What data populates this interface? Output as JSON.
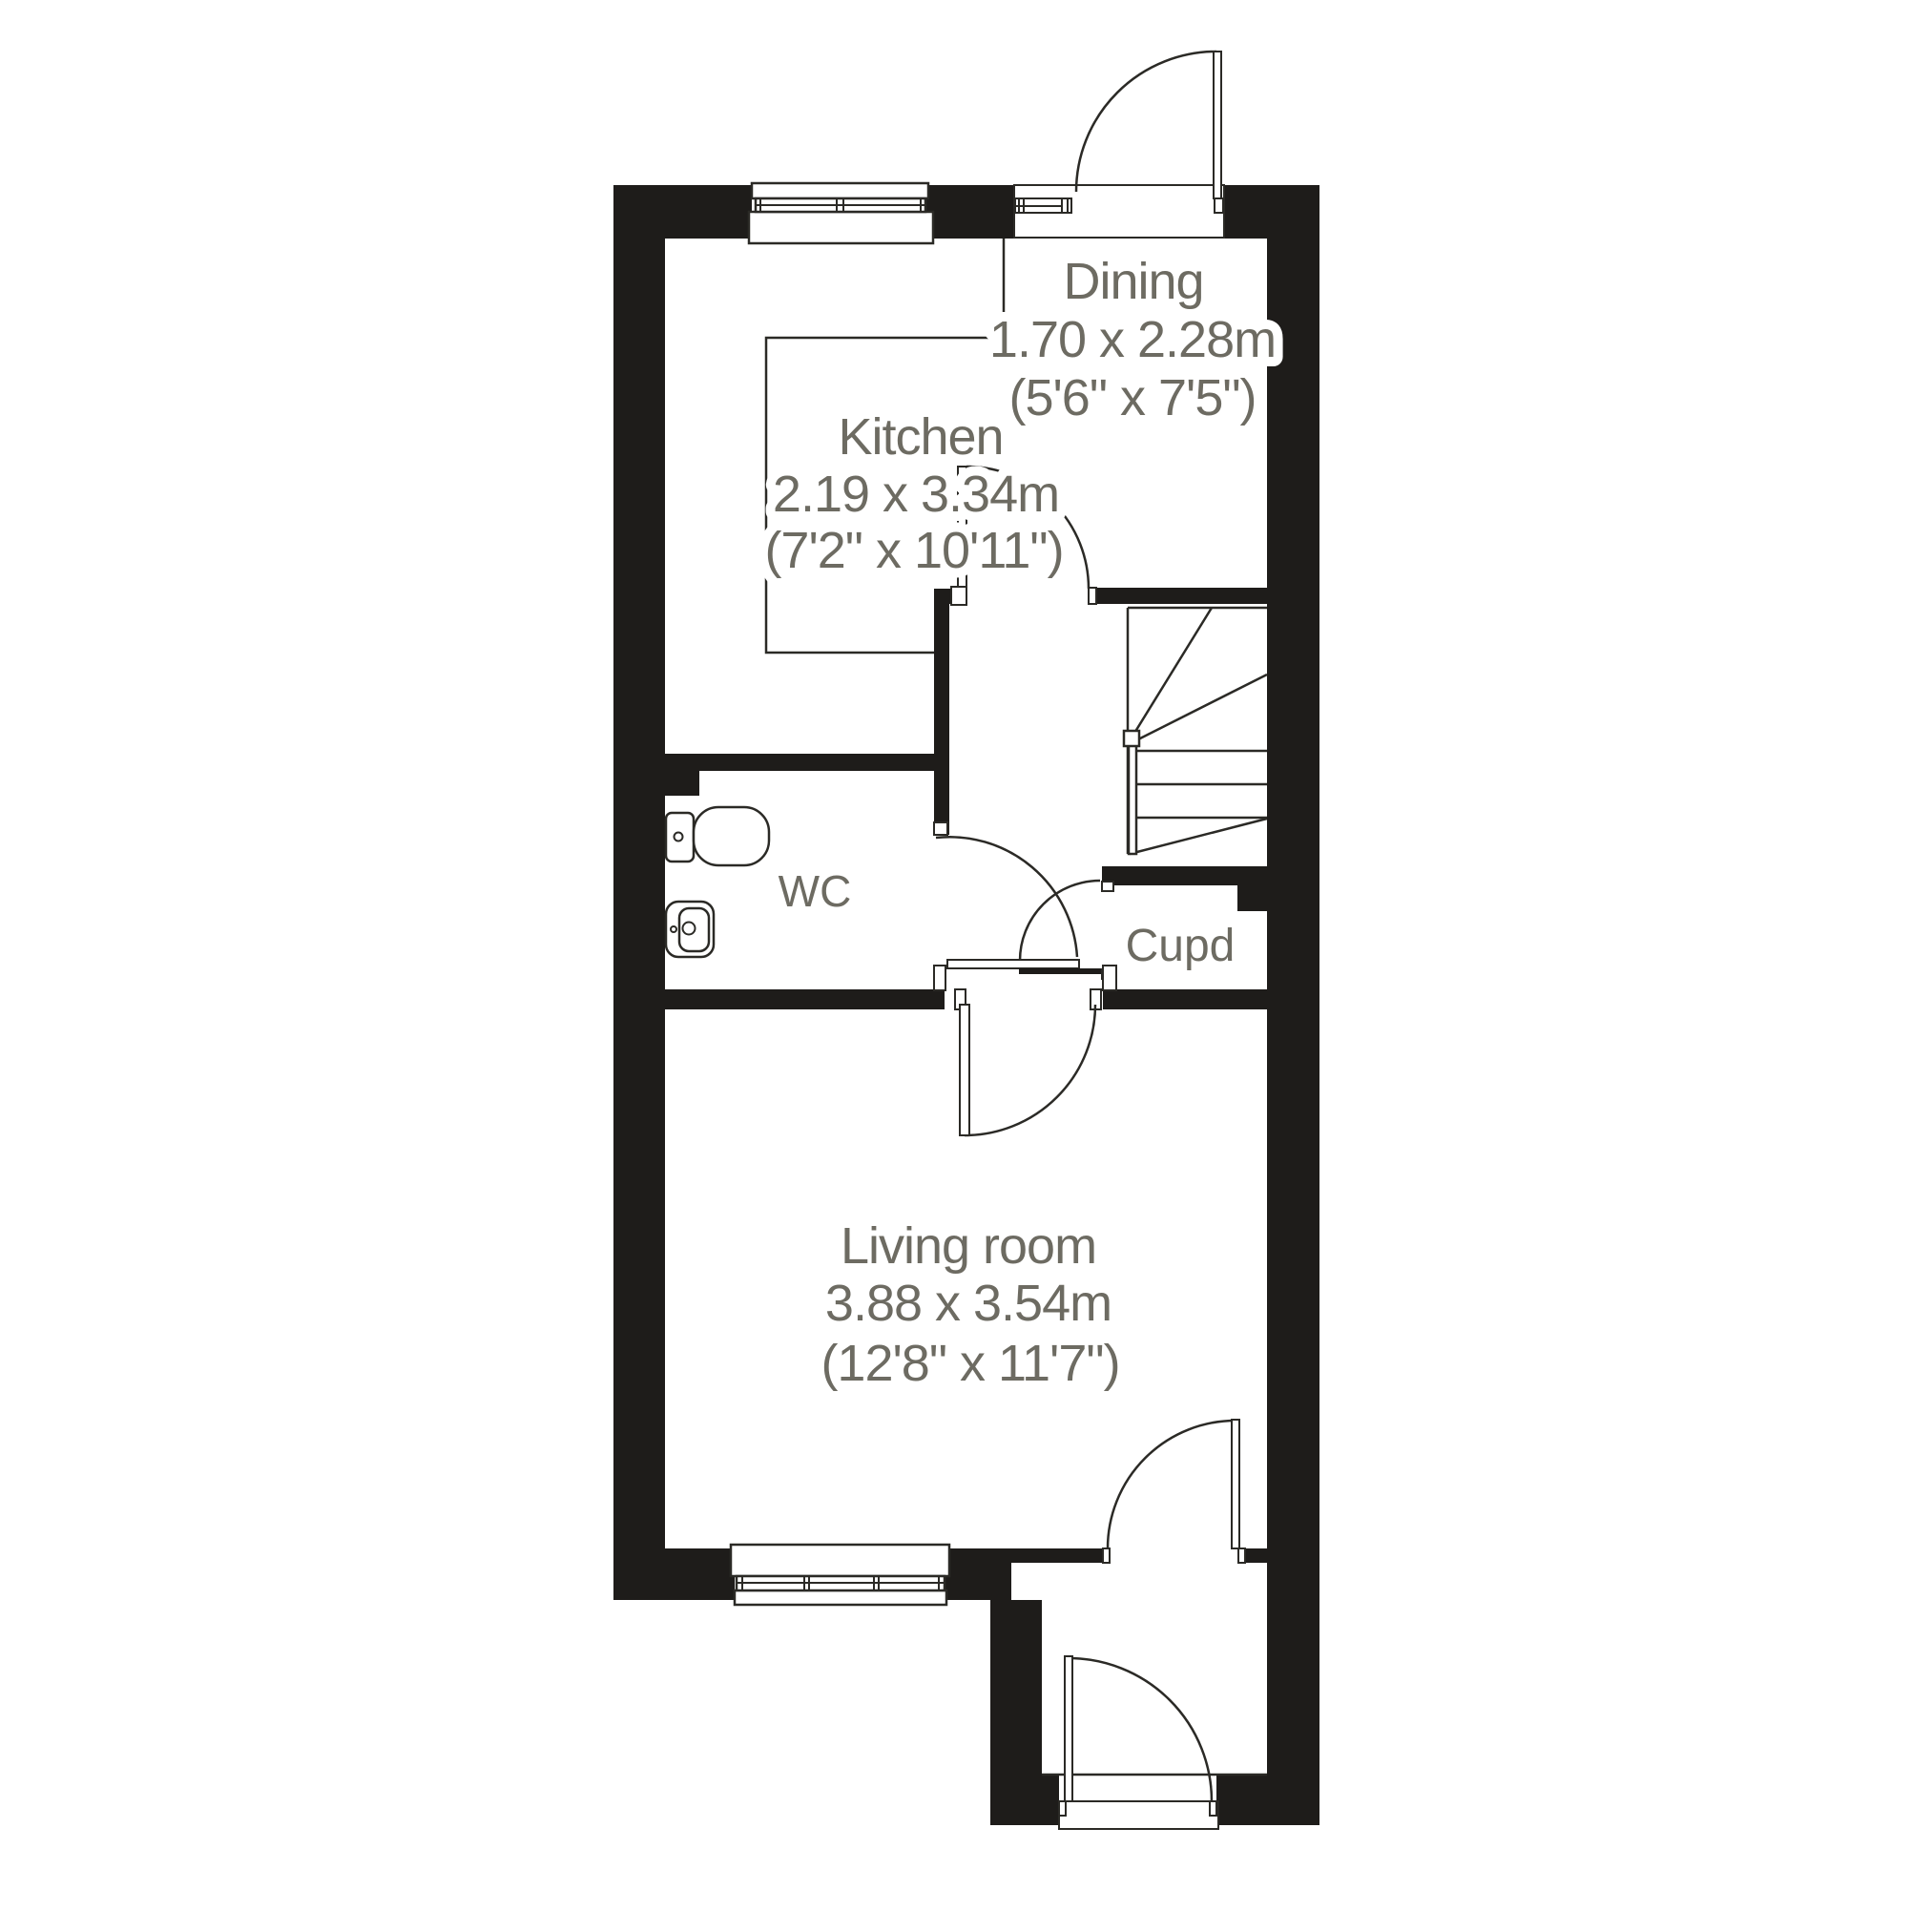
{
  "plan": {
    "type": "ground-floor-plan",
    "background": "#ffffff",
    "palette": {
      "wall": "#1e1c1a",
      "line": "#2b2a26",
      "label_text": "#6d6b62"
    },
    "rooms": {
      "dining": {
        "name": "Dining",
        "size_metric": "1.70 x 2.28m",
        "size_imperial": "(5'6\" x 7'5\")"
      },
      "kitchen": {
        "name": "Kitchen",
        "size_metric": "2.19 x 3.34m",
        "size_imperial": "(7'2\" x 10'11\")"
      },
      "wc": {
        "name": "WC"
      },
      "cupboard": {
        "name": "Cupd"
      },
      "living": {
        "name": "Living room",
        "size_metric": "3.88 x 3.54m",
        "size_imperial": "(12'8\" x 11'7\")"
      }
    },
    "features": [
      "entry-door-top",
      "kitchen-door",
      "wc-door",
      "cupboard-door",
      "living-room-door",
      "back-door",
      "front-door",
      "kitchen-window",
      "living-room-window",
      "entry-sidelight-window",
      "winder-staircase",
      "toilet",
      "sink",
      "porch"
    ]
  }
}
